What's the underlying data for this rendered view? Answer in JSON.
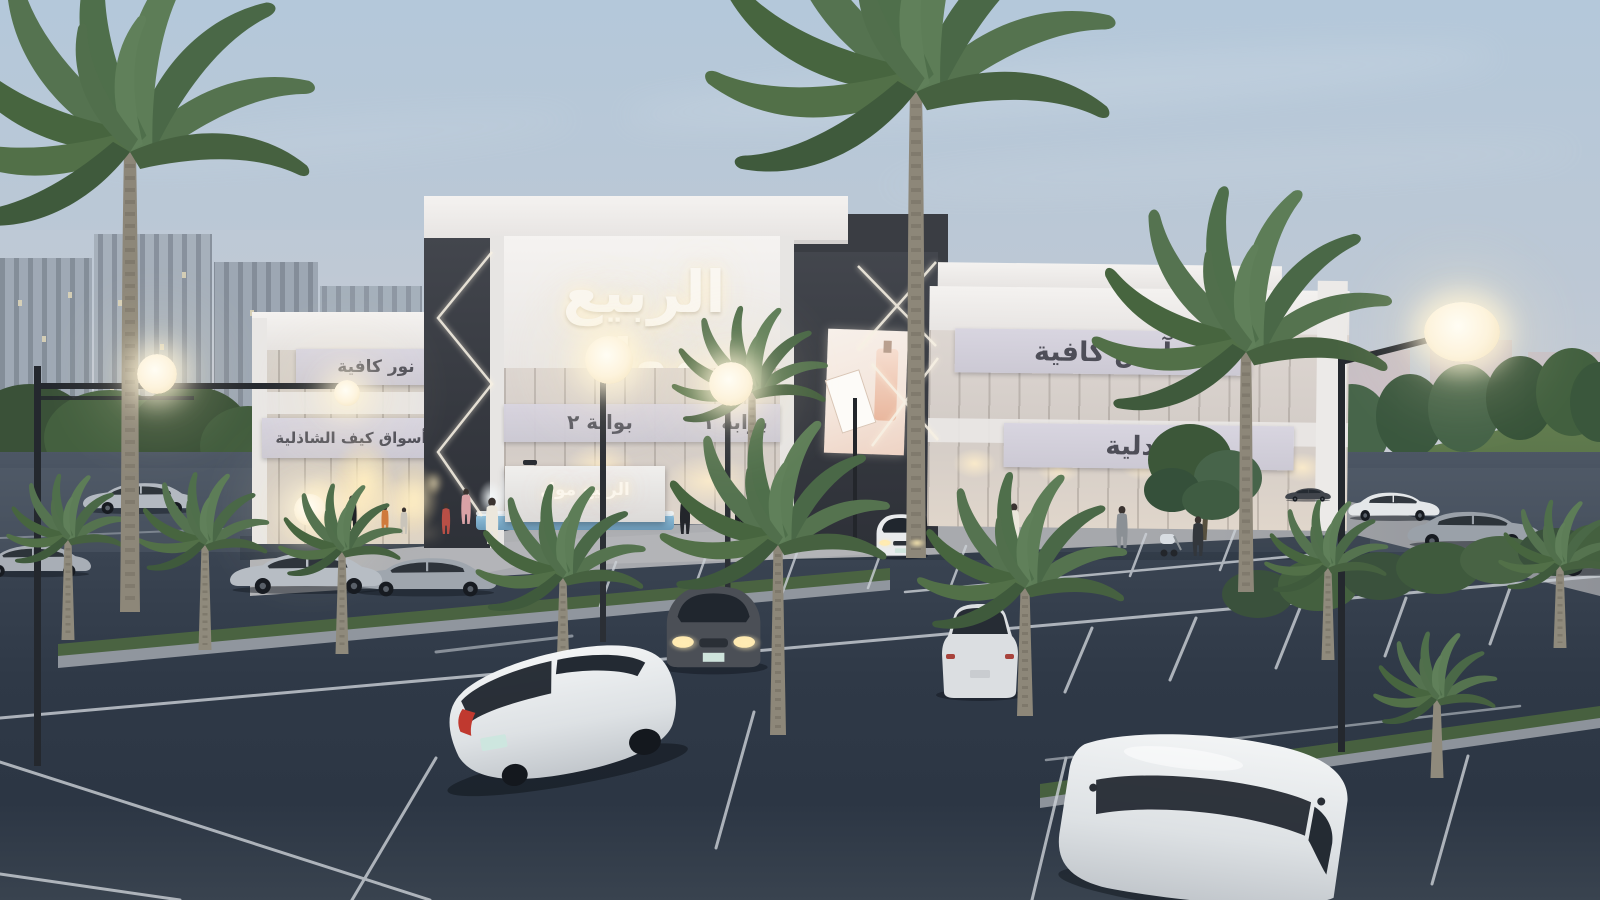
{
  "scene": {
    "name": "Al Rabie Mall — exterior architectural rendering at dusk",
    "setting": "shopping mall with parking lot, palm trees, street lamps and background city towers",
    "billboard_subject": "perfume advertisement",
    "objects": {
      "palm_trees": 15,
      "cars": 13,
      "street_lamps": 4,
      "people": 12
    }
  },
  "signs": {
    "main_facade": "الربيع مول",
    "entrance_monument": "الربيع مول",
    "gate_2": "بوابة ٢",
    "gate_1": "بوابة ١",
    "cafe_right": "آنس كافية",
    "pharmacy": "صيدلية",
    "cafe_left": "نور كافية",
    "market_left": "أسواق كيف الشاذلية"
  },
  "colors": {
    "sky_top": "#b4c8da",
    "sky_horizon": "#d9cdc8",
    "building_white": "#f2f0ee",
    "facade_dark": "#3b3e45",
    "glass_warm": "#d5cec8",
    "signage_plate": "#d2cfda",
    "lamp_glow": "#fdf3dc",
    "asphalt": "#2f3947",
    "grass": "#4a6341",
    "palm_green": "#54724e"
  }
}
